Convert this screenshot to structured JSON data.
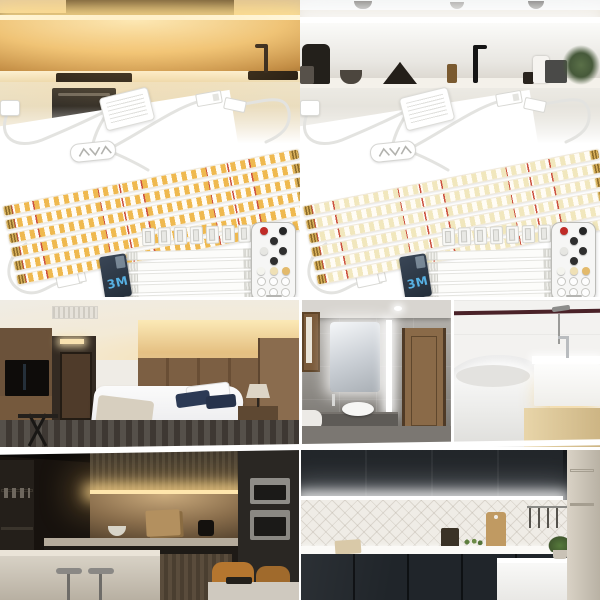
{
  "page": {
    "description": "Product photo collage for a 6-pack under-cabinet LED strip light kit, shown in warm white and daylight white versions with lifestyle application photos"
  },
  "kit_panels": {
    "warm": {
      "variant": "warm-white-kit",
      "strip_count": 6,
      "clip_count": 8,
      "jumper_count": 5,
      "adhesive_label": "3M",
      "chip_color": "#efb94f",
      "glow_color": "#ffd98f"
    },
    "cool": {
      "variant": "daylight-white-kit",
      "strip_count": 6,
      "clip_count": 8,
      "jumper_count": 5,
      "adhesive_label": "3M",
      "chip_color": "#f1e7bd",
      "glow_color": "#ffffff"
    }
  },
  "remote": {
    "rows": [
      [
        "#bf2b26",
        "#262626"
      ],
      [
        "#2e2e2e"
      ],
      [
        "#e6e6e2",
        "#2e2e2e"
      ],
      [
        "#2e2e2e"
      ],
      [
        "#f4f4ee",
        "#efe0b5",
        "#e3ba6b"
      ],
      [
        "#fdfdfd",
        "#fdfdfd",
        "#fdfdfd"
      ],
      [
        "#fdfdfd",
        "#fdfdfd",
        "#fdfdfd"
      ]
    ]
  },
  "scenes": {
    "warm_kitchen": "kitchen with warm white under-cabinet lighting",
    "cool_kitchen": "kitchen with daylight white under-shelf lighting",
    "bedroom": "hotel bedroom with warm cove lighting",
    "gray_bathroom": "gray stone bathroom with backlit mirror and light bar",
    "white_bathroom": "white bathroom with glowing floating vanity",
    "dark_kitchen": "dark wood kitchen with warm under-cabinet lighting",
    "black_kitchen": "black cabinet kitchen with cool under-cabinet lighting"
  },
  "colors": {
    "tape_card": "#2c3744",
    "tape_text": "#57b1e3",
    "remote_power_key": "#bf2b26",
    "warm_led_line": "#fff7da",
    "cool_led_line": "#ffffff"
  }
}
